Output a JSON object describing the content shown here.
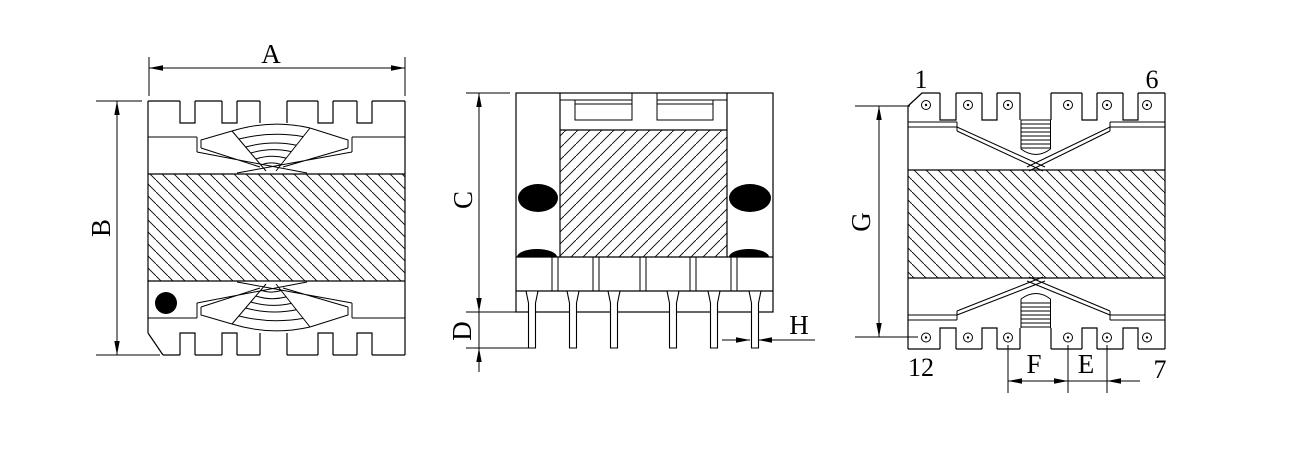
{
  "drawing": {
    "colors": {
      "line": "#000000",
      "background": "#ffffff"
    },
    "top_view": {
      "dim_width": "A",
      "dim_height": "B"
    },
    "front_view": {
      "dim_height": "C",
      "dim_pin_length": "D",
      "dim_pin_width": "H"
    },
    "side_view": {
      "dim_height": "G",
      "dim_center_pitch": "F",
      "dim_pin_pitch": "E",
      "pin_top_left": "1",
      "pin_top_right": "6",
      "pin_bottom_left": "12",
      "pin_bottom_right": "7"
    }
  }
}
